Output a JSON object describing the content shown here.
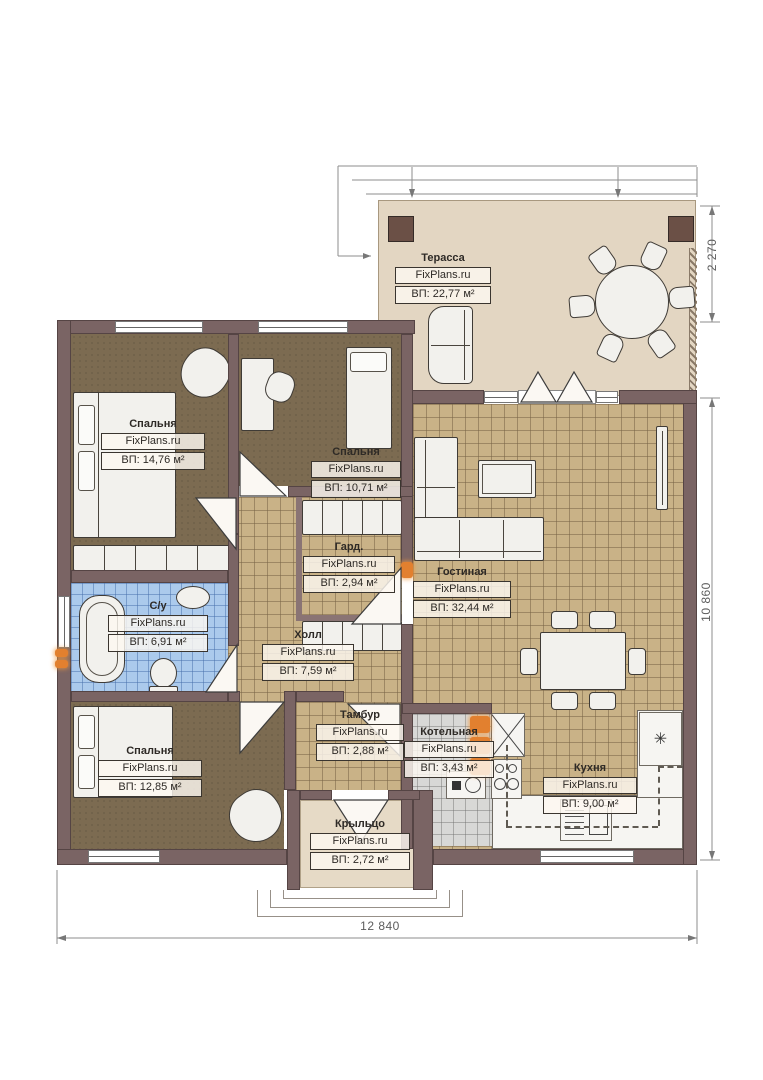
{
  "meta": {
    "brand": "FixPlans.ru",
    "area_unit": "м²"
  },
  "rooms": [
    {
      "id": "terrace",
      "name": "Терасса",
      "area": "ВП: 22,77 м²"
    },
    {
      "id": "bedroom-1",
      "name": "Спальня",
      "area": "ВП: 14,76 м²"
    },
    {
      "id": "bedroom-2",
      "name": "Спальня",
      "area": "ВП: 10,71 м²"
    },
    {
      "id": "wardrobe",
      "name": "Гард.",
      "area": "ВП: 2,94 м²"
    },
    {
      "id": "bathroom",
      "name": "С/у",
      "area": "ВП: 6,91 м²"
    },
    {
      "id": "hall",
      "name": "Холл",
      "area": "ВП: 7,59 м²"
    },
    {
      "id": "living-room",
      "name": "Гостиная",
      "area": "ВП: 32,44 м²"
    },
    {
      "id": "bedroom-3",
      "name": "Спальня",
      "area": "ВП: 12,85 м²"
    },
    {
      "id": "vestibule",
      "name": "Тамбур",
      "area": "ВП: 2,88 м²"
    },
    {
      "id": "boiler-room",
      "name": "Котельная",
      "area": "ВП: 3,43 м²"
    },
    {
      "id": "kitchen",
      "name": "Кухня",
      "area": "ВП: 9,00 м²"
    },
    {
      "id": "porch",
      "name": "Крыльцо",
      "area": "ВП: 2,72 м²"
    }
  ],
  "dimensions": {
    "terrace_depth": "2 270",
    "house_depth": "10 860",
    "house_width": "12 840"
  },
  "symbols": {
    "fridge": "✳"
  },
  "colors": {
    "wall": "#7a6464",
    "floor_wood": "#7c6b51",
    "floor_tile": "#c9b287",
    "floor_bath": "#abcaec",
    "floor_boiler": "#d8d8d6",
    "terrace": "#e3d6c2",
    "radiator": "#e2802f"
  }
}
